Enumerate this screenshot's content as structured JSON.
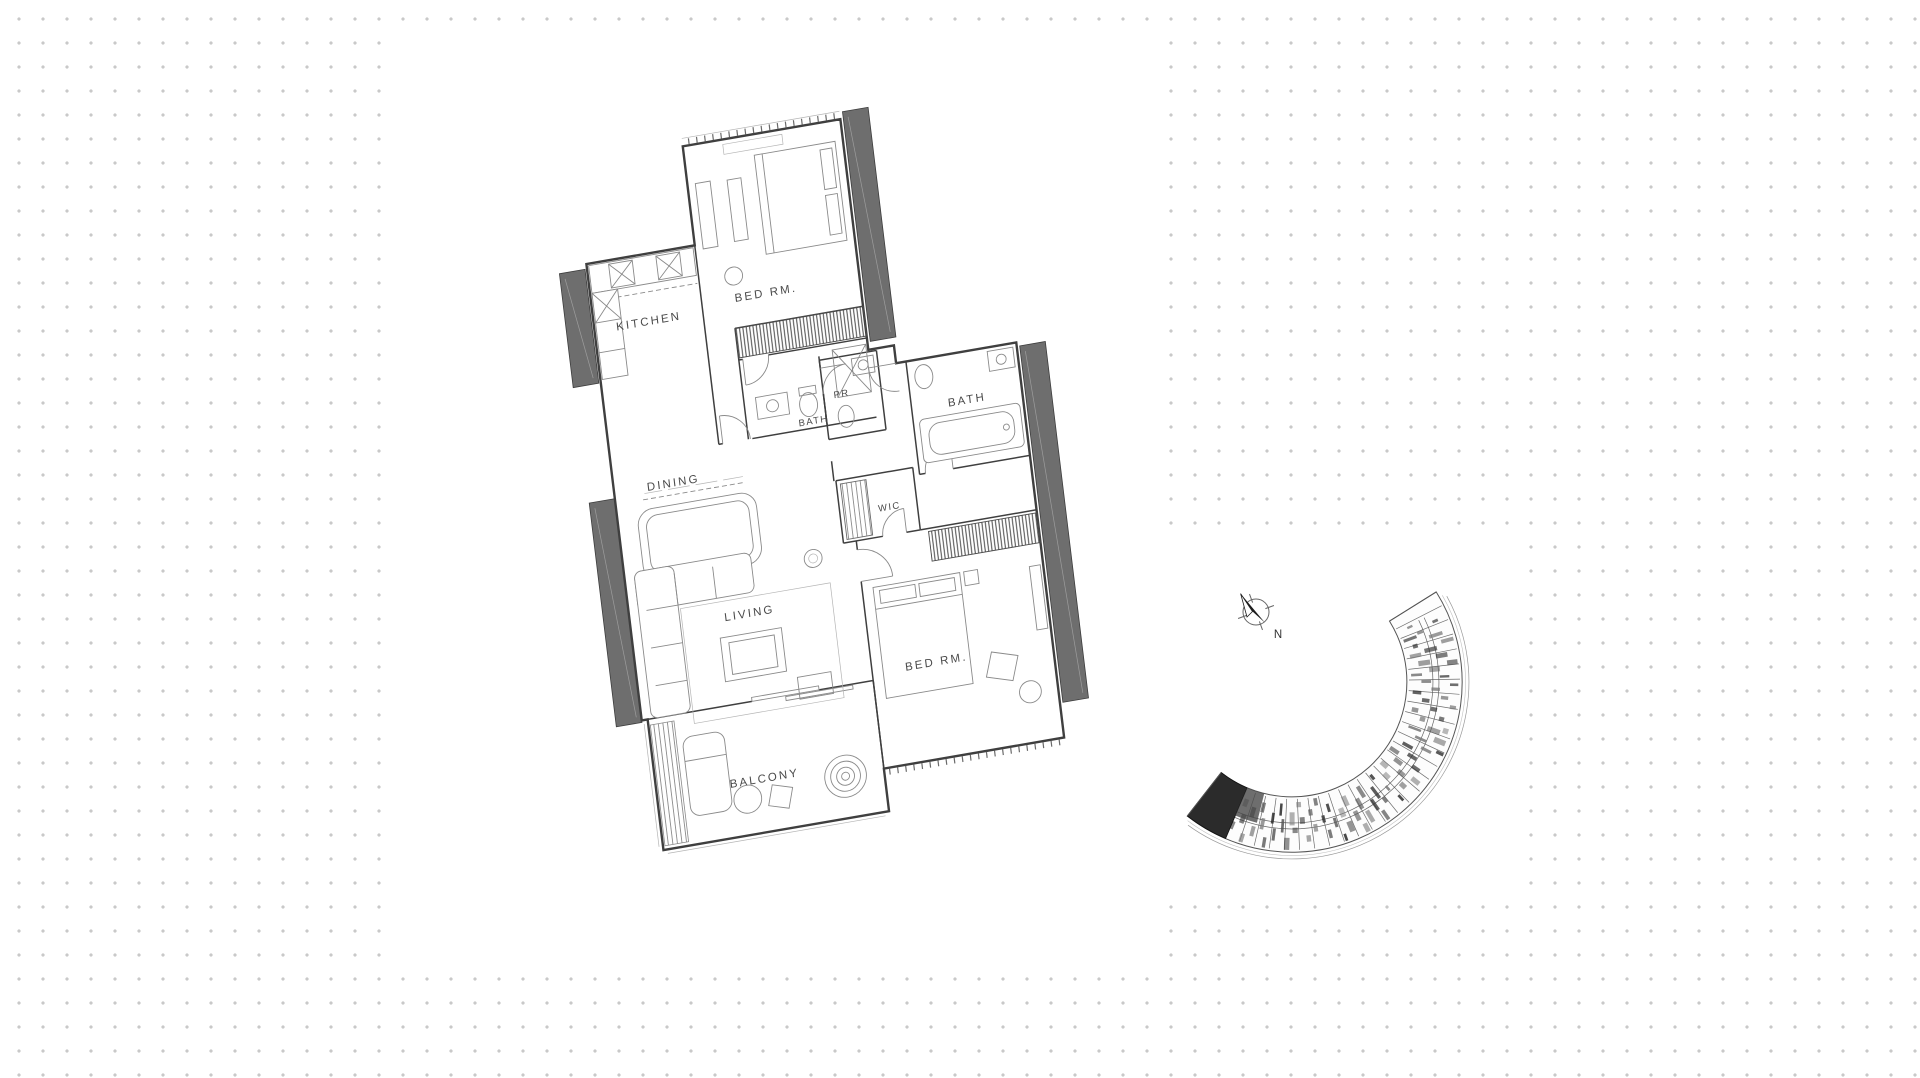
{
  "theme": {
    "dot": "#c9c9c9",
    "wall": "#3f3f3f",
    "thin": "#8a8a8a",
    "slab": "#6e6e6e",
    "label": "#4a4a4a",
    "keyplan_highlight": "#2b2b2b"
  },
  "floor_plan": {
    "rooms": [
      {
        "id": "bedroom-top",
        "label": "BED RM."
      },
      {
        "id": "bath-top",
        "label": "BATH"
      },
      {
        "id": "kitchen",
        "label": "KITCHEN"
      },
      {
        "id": "dining",
        "label": "DINING"
      },
      {
        "id": "living",
        "label": "LIVING"
      },
      {
        "id": "powder-room",
        "label": "PR"
      },
      {
        "id": "bath-master",
        "label": "BATH"
      },
      {
        "id": "wic",
        "label": "WIC"
      },
      {
        "id": "bedroom-master",
        "label": "BED RM."
      },
      {
        "id": "balcony",
        "label": "BALCONY"
      }
    ]
  },
  "key_plan": {
    "north_label": "N"
  }
}
